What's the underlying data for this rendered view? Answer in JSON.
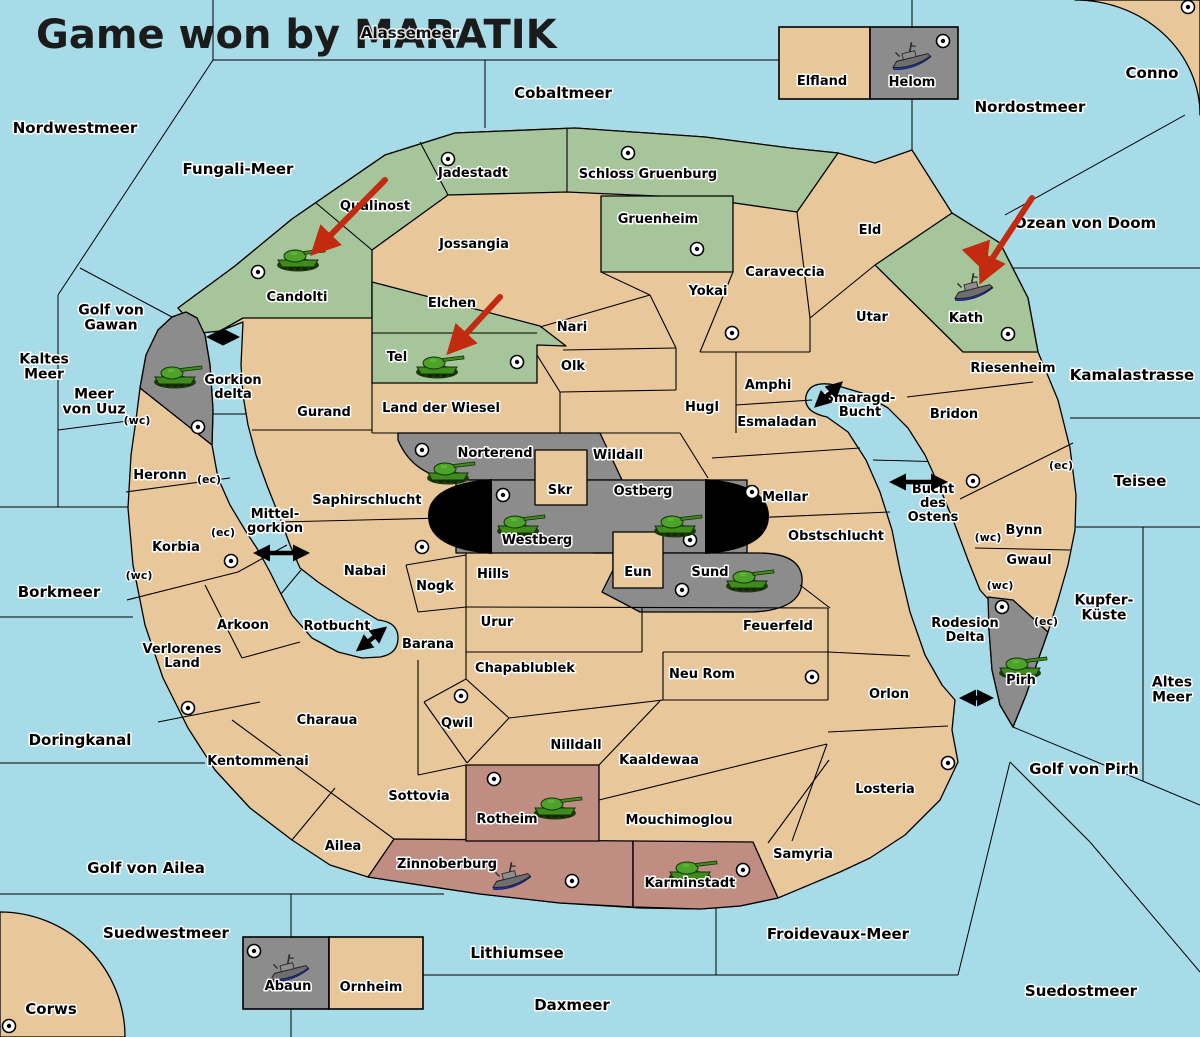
{
  "title": "Game won by MARATIK",
  "obscured_sea_label": "Alassemeer",
  "colors": {
    "sea": "#a8dbe8",
    "land": "#e8c89a",
    "green": "#a6c59a",
    "gray": "#8c8c8c",
    "maroon": "#c08d82",
    "black_feature": "#000000",
    "red_arrow": "#c32b10",
    "tank_green": "#3e8c1c",
    "ship_gray": "#707070",
    "ship_keel_blue": "#1f37c9",
    "border": "#000000"
  },
  "labels": [
    {
      "id": "nordwestmeer",
      "x": 75,
      "y": 133,
      "s": 15,
      "t": [
        "Nordwestmeer"
      ]
    },
    {
      "id": "cobaltmeer",
      "x": 563,
      "y": 98,
      "s": 15,
      "t": [
        "Cobaltmeer"
      ]
    },
    {
      "id": "nordostmeer",
      "x": 1030,
      "y": 112,
      "s": 15,
      "t": [
        "Nordostmeer"
      ]
    },
    {
      "id": "conno",
      "x": 1152,
      "y": 78,
      "s": 15,
      "t": [
        "Conno"
      ]
    },
    {
      "id": "fungali-meer",
      "x": 238,
      "y": 174,
      "s": 15,
      "t": [
        "Fungali-Meer"
      ]
    },
    {
      "id": "golf-von-gawan",
      "x": 111,
      "y": 322,
      "s": 14,
      "t": [
        "Golf von",
        "Gawan"
      ]
    },
    {
      "id": "kaltes-meer",
      "x": 44,
      "y": 371,
      "s": 14,
      "t": [
        "Kaltes",
        "Meer"
      ]
    },
    {
      "id": "meer-von-uuz",
      "x": 94,
      "y": 406,
      "s": 14,
      "t": [
        "Meer",
        "von Uuz"
      ]
    },
    {
      "id": "ozean-von-doom",
      "x": 1085,
      "y": 228,
      "s": 15,
      "t": [
        "Ozean von Doom"
      ]
    },
    {
      "id": "kamalastrasse",
      "x": 1132,
      "y": 380,
      "s": 15,
      "t": [
        "Kamalastrasse"
      ]
    },
    {
      "id": "teisee",
      "x": 1140,
      "y": 486,
      "s": 15,
      "t": [
        "Teisee"
      ]
    },
    {
      "id": "kupfer-kueste",
      "x": 1104,
      "y": 612,
      "s": 14,
      "t": [
        "Kupfer-",
        "Küste"
      ]
    },
    {
      "id": "altes-meer",
      "x": 1172,
      "y": 694,
      "s": 14,
      "t": [
        "Altes",
        "Meer"
      ]
    },
    {
      "id": "borkmeer",
      "x": 59,
      "y": 597,
      "s": 15,
      "t": [
        "Borkmeer"
      ]
    },
    {
      "id": "doringkanal",
      "x": 80,
      "y": 745,
      "s": 15,
      "t": [
        "Doringkanal"
      ]
    },
    {
      "id": "golf-von-ailea",
      "x": 146,
      "y": 873,
      "s": 15,
      "t": [
        "Golf von Ailea"
      ]
    },
    {
      "id": "suedwestmeer",
      "x": 166,
      "y": 938,
      "s": 15,
      "t": [
        "Suedwestmeer"
      ]
    },
    {
      "id": "corws",
      "x": 51,
      "y": 1014,
      "s": 15,
      "t": [
        "Corws"
      ]
    },
    {
      "id": "lithiumsee",
      "x": 517,
      "y": 958,
      "s": 15,
      "t": [
        "Lithiumsee"
      ]
    },
    {
      "id": "daxmeer",
      "x": 572,
      "y": 1010,
      "s": 15,
      "t": [
        "Daxmeer"
      ]
    },
    {
      "id": "froidevaux-meer",
      "x": 838,
      "y": 939,
      "s": 15,
      "t": [
        "Froidevaux-Meer"
      ]
    },
    {
      "id": "suedostmeer",
      "x": 1081,
      "y": 996,
      "s": 15,
      "t": [
        "Suedostmeer"
      ]
    },
    {
      "id": "golf-von-pirh",
      "x": 1084,
      "y": 774,
      "s": 15,
      "t": [
        "Golf von Pirh"
      ]
    },
    {
      "id": "gorkion-delta",
      "x": 233,
      "y": 391,
      "s": 13,
      "t": [
        "Gorkion",
        "delta"
      ]
    },
    {
      "id": "mittelgorkion",
      "x": 275,
      "y": 525,
      "s": 13,
      "t": [
        "Mittel-",
        "gorkion"
      ]
    },
    {
      "id": "rotbucht",
      "x": 337,
      "y": 630,
      "s": 13,
      "t": [
        "Rotbucht"
      ]
    },
    {
      "id": "smaragd-bucht",
      "x": 860,
      "y": 409,
      "s": 13,
      "t": [
        "Smaragd-",
        "Bucht"
      ]
    },
    {
      "id": "bucht-des-ostens",
      "x": 933,
      "y": 507,
      "s": 13,
      "t": [
        "Bucht",
        "des",
        "Ostens"
      ]
    },
    {
      "id": "rodesion-delta",
      "x": 965,
      "y": 634,
      "s": 13,
      "t": [
        "Rodesion",
        "Delta"
      ]
    },
    {
      "id": "qualinost",
      "x": 375,
      "y": 210,
      "s": 13,
      "t": [
        "Qualinost"
      ]
    },
    {
      "id": "candolti",
      "x": 297,
      "y": 301,
      "s": 13,
      "t": [
        "Candolti"
      ]
    },
    {
      "id": "jadestadt",
      "x": 473,
      "y": 177,
      "s": 13,
      "t": [
        "Jadestadt"
      ]
    },
    {
      "id": "schloss-gruenburg",
      "x": 648,
      "y": 178,
      "s": 13,
      "t": [
        "Schloss Gruenburg"
      ]
    },
    {
      "id": "gruenheim",
      "x": 658,
      "y": 223,
      "s": 13,
      "t": [
        "Gruenheim"
      ]
    },
    {
      "id": "jossangia",
      "x": 474,
      "y": 248,
      "s": 13,
      "t": [
        "Jossangia"
      ]
    },
    {
      "id": "elchen",
      "x": 452,
      "y": 307,
      "s": 13,
      "t": [
        "Elchen"
      ]
    },
    {
      "id": "tel",
      "x": 397,
      "y": 361,
      "s": 13,
      "t": [
        "Tel"
      ]
    },
    {
      "id": "nari",
      "x": 572,
      "y": 331,
      "s": 13,
      "t": [
        "Nari"
      ]
    },
    {
      "id": "olk",
      "x": 573,
      "y": 370,
      "s": 13,
      "t": [
        "Olk"
      ]
    },
    {
      "id": "yokai",
      "x": 708,
      "y": 295,
      "s": 13,
      "t": [
        "Yokai"
      ]
    },
    {
      "id": "caraveccia",
      "x": 785,
      "y": 276,
      "s": 13,
      "t": [
        "Caraveccia"
      ]
    },
    {
      "id": "eld",
      "x": 870,
      "y": 234,
      "s": 13,
      "t": [
        "Eld"
      ]
    },
    {
      "id": "utar",
      "x": 872,
      "y": 321,
      "s": 13,
      "t": [
        "Utar"
      ]
    },
    {
      "id": "kath",
      "x": 966,
      "y": 322,
      "s": 13,
      "t": [
        "Kath"
      ]
    },
    {
      "id": "riesenheim",
      "x": 1013,
      "y": 372,
      "s": 13,
      "t": [
        "Riesenheim"
      ]
    },
    {
      "id": "bridon",
      "x": 954,
      "y": 418,
      "s": 13,
      "t": [
        "Bridon"
      ]
    },
    {
      "id": "gurand",
      "x": 324,
      "y": 416,
      "s": 13,
      "t": [
        "Gurand"
      ]
    },
    {
      "id": "land-der-wiesel",
      "x": 441,
      "y": 412,
      "s": 13,
      "t": [
        "Land der Wiesel"
      ]
    },
    {
      "id": "norterend",
      "x": 495,
      "y": 457,
      "s": 13,
      "t": [
        "Norterend"
      ]
    },
    {
      "id": "wildall",
      "x": 618,
      "y": 459,
      "s": 13,
      "t": [
        "Wildall"
      ]
    },
    {
      "id": "skr",
      "x": 560,
      "y": 494,
      "s": 13,
      "t": [
        "Skr"
      ]
    },
    {
      "id": "ostberg",
      "x": 643,
      "y": 495,
      "s": 13,
      "t": [
        "Ostberg"
      ]
    },
    {
      "id": "westberg",
      "x": 537,
      "y": 544,
      "s": 13,
      "t": [
        "Westberg"
      ]
    },
    {
      "id": "eun",
      "x": 638,
      "y": 576,
      "s": 13,
      "t": [
        "Eun"
      ]
    },
    {
      "id": "sund",
      "x": 710,
      "y": 576,
      "s": 13,
      "t": [
        "Sund"
      ]
    },
    {
      "id": "mellar",
      "x": 785,
      "y": 501,
      "s": 13,
      "t": [
        "Mellar"
      ]
    },
    {
      "id": "hugl",
      "x": 702,
      "y": 411,
      "s": 13,
      "t": [
        "Hugl"
      ]
    },
    {
      "id": "esmaladan",
      "x": 777,
      "y": 426,
      "s": 13,
      "t": [
        "Esmaladan"
      ]
    },
    {
      "id": "amphi",
      "x": 768,
      "y": 389,
      "s": 13,
      "t": [
        "Amphi"
      ]
    },
    {
      "id": "obstschlucht",
      "x": 836,
      "y": 540,
      "s": 13,
      "t": [
        "Obstschlucht"
      ]
    },
    {
      "id": "heronn",
      "x": 160,
      "y": 479,
      "s": 13,
      "t": [
        "Heronn"
      ]
    },
    {
      "id": "saphirschlucht",
      "x": 367,
      "y": 504,
      "s": 13,
      "t": [
        "Saphirschlucht"
      ]
    },
    {
      "id": "korbia",
      "x": 176,
      "y": 551,
      "s": 13,
      "t": [
        "Korbia"
      ]
    },
    {
      "id": "nabai",
      "x": 365,
      "y": 575,
      "s": 13,
      "t": [
        "Nabai"
      ]
    },
    {
      "id": "nogk",
      "x": 435,
      "y": 590,
      "s": 13,
      "t": [
        "Nogk"
      ]
    },
    {
      "id": "hills",
      "x": 493,
      "y": 578,
      "s": 13,
      "t": [
        "Hills"
      ]
    },
    {
      "id": "urur",
      "x": 497,
      "y": 626,
      "s": 13,
      "t": [
        "Urur"
      ]
    },
    {
      "id": "feuerfeld",
      "x": 778,
      "y": 630,
      "s": 13,
      "t": [
        "Feuerfeld"
      ]
    },
    {
      "id": "arkoon",
      "x": 243,
      "y": 629,
      "s": 13,
      "t": [
        "Arkoon"
      ]
    },
    {
      "id": "barana",
      "x": 428,
      "y": 648,
      "s": 13,
      "t": [
        "Barana"
      ]
    },
    {
      "id": "chapablublek",
      "x": 525,
      "y": 672,
      "s": 13,
      "t": [
        "Chapablublek"
      ]
    },
    {
      "id": "neu-rom",
      "x": 702,
      "y": 678,
      "s": 13,
      "t": [
        "Neu Rom"
      ]
    },
    {
      "id": "verlorenes-land",
      "x": 182,
      "y": 660,
      "s": 13,
      "t": [
        "Verlorenes",
        "Land"
      ]
    },
    {
      "id": "charaua",
      "x": 327,
      "y": 724,
      "s": 13,
      "t": [
        "Charaua"
      ]
    },
    {
      "id": "qwil",
      "x": 457,
      "y": 727,
      "s": 13,
      "t": [
        "Qwil"
      ]
    },
    {
      "id": "nilldall",
      "x": 576,
      "y": 749,
      "s": 13,
      "t": [
        "Nilldall"
      ]
    },
    {
      "id": "kaaldewaa",
      "x": 659,
      "y": 764,
      "s": 13,
      "t": [
        "Kaaldewaa"
      ]
    },
    {
      "id": "kentommenai",
      "x": 258,
      "y": 765,
      "s": 13,
      "t": [
        "Kentommenai"
      ]
    },
    {
      "id": "sottovia",
      "x": 419,
      "y": 800,
      "s": 13,
      "t": [
        "Sottovia"
      ]
    },
    {
      "id": "rotheim",
      "x": 507,
      "y": 823,
      "s": 13,
      "t": [
        "Rotheim"
      ]
    },
    {
      "id": "mouchimoglou",
      "x": 679,
      "y": 824,
      "s": 13,
      "t": [
        "Mouchimoglou"
      ]
    },
    {
      "id": "orlon",
      "x": 889,
      "y": 698,
      "s": 13,
      "t": [
        "Orlon"
      ]
    },
    {
      "id": "losteria",
      "x": 885,
      "y": 793,
      "s": 13,
      "t": [
        "Losteria"
      ]
    },
    {
      "id": "samyria",
      "x": 803,
      "y": 858,
      "s": 13,
      "t": [
        "Samyria"
      ]
    },
    {
      "id": "zinnoberburg",
      "x": 447,
      "y": 868,
      "s": 13,
      "t": [
        "Zinnoberburg"
      ]
    },
    {
      "id": "karminstadt",
      "x": 690,
      "y": 887,
      "s": 13,
      "t": [
        "Karminstadt"
      ]
    },
    {
      "id": "ailea",
      "x": 343,
      "y": 850,
      "s": 13,
      "t": [
        "Ailea"
      ]
    },
    {
      "id": "bynn",
      "x": 1024,
      "y": 534,
      "s": 13,
      "t": [
        "Bynn"
      ]
    },
    {
      "id": "gwaul",
      "x": 1029,
      "y": 564,
      "s": 13,
      "t": [
        "Gwaul"
      ]
    },
    {
      "id": "pirh",
      "x": 1021,
      "y": 684,
      "s": 13,
      "t": [
        "Pirh"
      ]
    },
    {
      "id": "elfland",
      "x": 822,
      "y": 85,
      "s": 13,
      "t": [
        "Elfland"
      ]
    },
    {
      "id": "helom",
      "x": 912,
      "y": 86,
      "s": 13,
      "t": [
        "Helom"
      ]
    },
    {
      "id": "abaun",
      "x": 288,
      "y": 990,
      "s": 13,
      "t": [
        "Abaun"
      ]
    },
    {
      "id": "ornheim",
      "x": 371,
      "y": 991,
      "s": 13,
      "t": [
        "Ornheim"
      ]
    }
  ],
  "coast_markers": [
    {
      "t": "(wc)",
      "x": 137,
      "y": 420
    },
    {
      "t": "(ec)",
      "x": 209,
      "y": 479
    },
    {
      "t": "(ec)",
      "x": 223,
      "y": 532
    },
    {
      "t": "(wc)",
      "x": 139,
      "y": 575
    },
    {
      "t": "(ec)",
      "x": 1061,
      "y": 465
    },
    {
      "t": "(wc)",
      "x": 988,
      "y": 537
    },
    {
      "t": "(wc)",
      "x": 1000,
      "y": 585
    },
    {
      "t": "(ec)",
      "x": 1046,
      "y": 621
    }
  ],
  "supply_centers": [
    {
      "region": "candolti",
      "x": 258,
      "y": 272
    },
    {
      "region": "jadestadt",
      "x": 448,
      "y": 159
    },
    {
      "region": "schloss-gruenburg",
      "x": 628,
      "y": 153
    },
    {
      "region": "gruenheim",
      "x": 697,
      "y": 249
    },
    {
      "region": "yokai",
      "x": 732,
      "y": 333
    },
    {
      "region": "tel",
      "x": 517,
      "y": 362
    },
    {
      "region": "kath",
      "x": 1008,
      "y": 334
    },
    {
      "region": "helom",
      "x": 943,
      "y": 41
    },
    {
      "region": "conno",
      "x": 1188,
      "y": 7
    },
    {
      "region": "gawar",
      "x": 198,
      "y": 427
    },
    {
      "region": "norterend",
      "x": 422,
      "y": 450
    },
    {
      "region": "westberg",
      "x": 503,
      "y": 495
    },
    {
      "region": "ostberg",
      "x": 690,
      "y": 540
    },
    {
      "region": "mellar",
      "x": 752,
      "y": 492
    },
    {
      "region": "sund",
      "x": 682,
      "y": 590
    },
    {
      "region": "nabai",
      "x": 422,
      "y": 547
    },
    {
      "region": "korbia",
      "x": 231,
      "y": 561
    },
    {
      "region": "verlorenes-land",
      "x": 188,
      "y": 708
    },
    {
      "region": "qwil",
      "x": 461,
      "y": 696
    },
    {
      "region": "neu-rom",
      "x": 812,
      "y": 677
    },
    {
      "region": "bridon",
      "x": 973,
      "y": 481
    },
    {
      "region": "pirh",
      "x": 1002,
      "y": 607
    },
    {
      "region": "losteria",
      "x": 948,
      "y": 763
    },
    {
      "region": "rotheim",
      "x": 494,
      "y": 779
    },
    {
      "region": "zinnoberburg",
      "x": 572,
      "y": 881
    },
    {
      "region": "karminstadt",
      "x": 743,
      "y": 870
    },
    {
      "region": "abaun",
      "x": 254,
      "y": 951
    },
    {
      "region": "corws",
      "x": 9,
      "y": 1026
    }
  ],
  "units": [
    {
      "type": "tank",
      "region": "candolti",
      "x": 298,
      "y": 256
    },
    {
      "type": "tank",
      "region": "tel",
      "x": 437,
      "y": 363
    },
    {
      "type": "tank",
      "region": "gawar",
      "x": 175,
      "y": 373
    },
    {
      "type": "tank",
      "region": "norterend",
      "x": 448,
      "y": 469
    },
    {
      "type": "tank",
      "region": "westberg",
      "x": 518,
      "y": 522
    },
    {
      "type": "tank",
      "region": "ostberg",
      "x": 675,
      "y": 522
    },
    {
      "type": "tank",
      "region": "sund",
      "x": 747,
      "y": 577
    },
    {
      "type": "tank",
      "region": "pirh",
      "x": 1020,
      "y": 664
    },
    {
      "type": "tank",
      "region": "rotheim",
      "x": 555,
      "y": 804
    },
    {
      "type": "tank",
      "region": "karminstadt",
      "x": 690,
      "y": 868
    },
    {
      "type": "ship",
      "region": "kath",
      "x": 972,
      "y": 288
    },
    {
      "type": "ship",
      "region": "helom",
      "x": 910,
      "y": 57
    },
    {
      "type": "ship",
      "region": "zinnoberburg",
      "x": 510,
      "y": 877
    },
    {
      "type": "ship",
      "region": "abaun",
      "x": 288,
      "y": 969
    }
  ],
  "red_arrows": [
    {
      "points": [
        [
          385,
          180
        ],
        [
          316,
          250
        ]
      ]
    },
    {
      "points": [
        [
          500,
          297
        ],
        [
          452,
          349
        ]
      ]
    },
    {
      "points": [
        [
          1032,
          198
        ],
        [
          990,
          262
        ],
        [
          983,
          277
        ]
      ]
    },
    {
      "points": [
        [
          977,
          248
        ],
        [
          983,
          265
        ]
      ]
    }
  ],
  "strait_arrows": [
    {
      "x1": 210,
      "y1": 337,
      "x2": 236,
      "y2": 337
    },
    {
      "x1": 257,
      "y1": 553,
      "x2": 306,
      "y2": 553
    },
    {
      "x1": 359,
      "y1": 649,
      "x2": 384,
      "y2": 629
    },
    {
      "x1": 817,
      "y1": 405,
      "x2": 840,
      "y2": 384
    },
    {
      "x1": 893,
      "y1": 482,
      "x2": 944,
      "y2": 482
    },
    {
      "x1": 963,
      "y1": 698,
      "x2": 990,
      "y2": 698
    }
  ]
}
